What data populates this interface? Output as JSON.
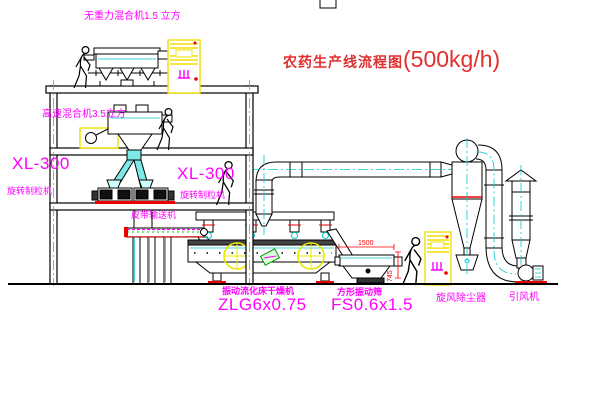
{
  "title": {
    "zh": "农药生产线流程图",
    "capacity": "(500kg/h)"
  },
  "labels": {
    "gravity_mixer": "无重力混合机1.5 立方",
    "high_speed_mixer": "高速混合机3.5立方",
    "granulator_left_model": "XL-300",
    "granulator_left_name": "旋转制粒机",
    "granulator_mid_model": "XL-300",
    "granulator_mid_name": "旋转制粒机",
    "belt_conveyor": "皮带输送机",
    "dryer_name": "振动流化床干燥机",
    "dryer_model": "ZLG6x0.75",
    "sieve_name": "方形振动筛",
    "sieve_model": "FS0.6x1.5",
    "cyclone": "旋风除尘器",
    "fan": "引风机"
  },
  "dimensions": {
    "sieve_length": "1500",
    "sieve_height": "745"
  },
  "colors": {
    "label_magenta": "#ff00ff",
    "title_red": "#e03030",
    "dimension_red": "#ff0000",
    "accent_cyan": "#00cccc",
    "highlight_yellow": "#f0e000",
    "base_red": "#ee0000",
    "belt_green": "#00cc00"
  }
}
